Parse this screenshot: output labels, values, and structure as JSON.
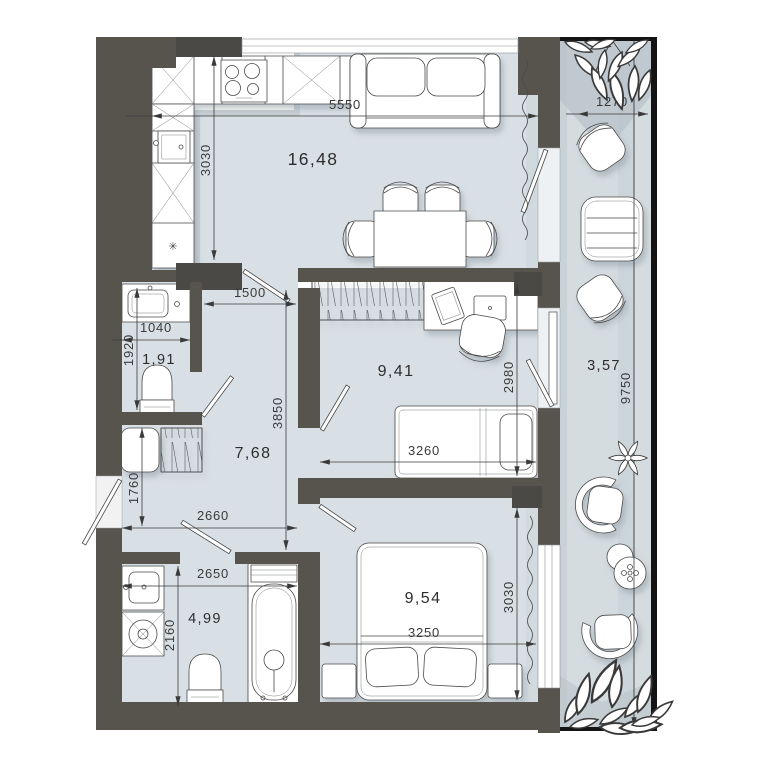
{
  "plan": {
    "type": "apartment-floor-plan",
    "rooms": {
      "kitchen_living": {
        "area": "16,48"
      },
      "wc": {
        "area": "1,91"
      },
      "hallway": {
        "area": "7,68"
      },
      "room": {
        "area": "9,41"
      },
      "bathroom": {
        "area": "4,99"
      },
      "bedroom": {
        "area": "9,54"
      },
      "balcony": {
        "area": "3,57"
      }
    },
    "dimensions_mm": {
      "living_width": "5550",
      "living_depth": "3030",
      "balcony_width": "1270",
      "balcony_length": "9750",
      "hall_opening": "1500",
      "wc_width": "1040",
      "wc_depth": "1920",
      "hall_depth": "3850",
      "room_depth": "2980",
      "room_width": "3260",
      "hall_nook_depth": "1760",
      "hall_width": "2660",
      "bath_width": "2650",
      "bath_depth": "2160",
      "bedroom_width": "3250",
      "bedroom_depth": "3030"
    },
    "icons": {
      "fridge_snowflake": "✳"
    },
    "colors": {
      "wall": "#57544e",
      "wall_dark": "#4b4945",
      "floor": "#d9e0e5",
      "balcony_floor": "#d5dce0",
      "dim_text": "#3a3a3a",
      "outline": "#4a4a4a",
      "exterior_line": "#141414"
    }
  }
}
